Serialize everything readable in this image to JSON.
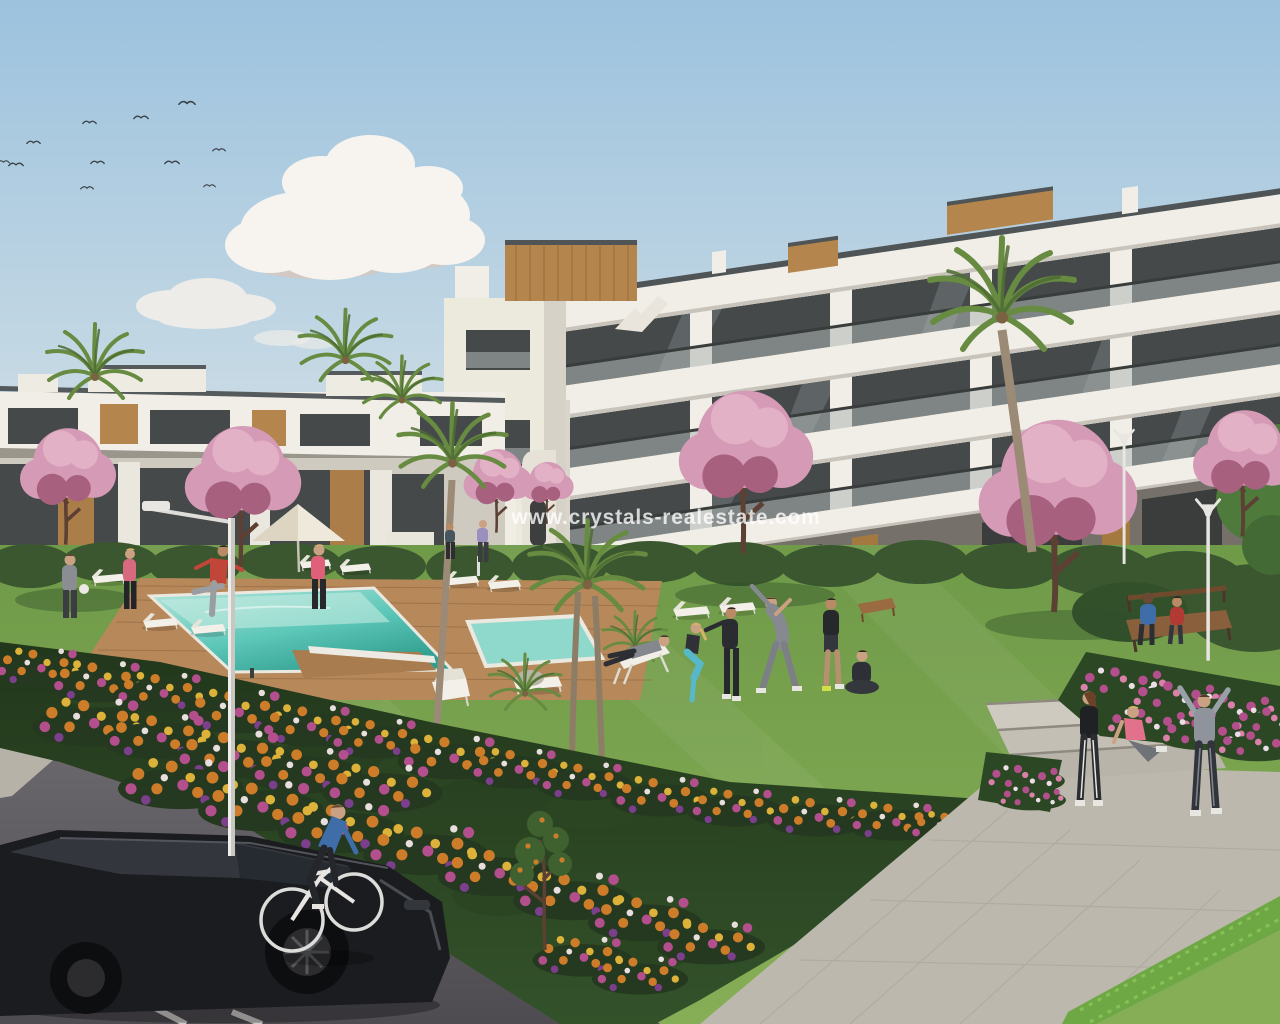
{
  "watermark": {
    "text": "www.crystals-realestate.com"
  },
  "colors": {
    "sky_top": "#9cc2de",
    "sky_horizon": "#e9e4d8",
    "cloud_white": "#f7f4ef",
    "grass_green": "#6f9a48",
    "grass_light": "#86ae56",
    "hedge_dark": "#3a5730",
    "hedge_bright": "#6da844",
    "pool_shallow": "#b7e6dc",
    "pool_water": "#5ec8b9",
    "pool_deep": "#2f9d8f",
    "pool_coping": "#ebe8e0",
    "deck_wood": "#b6885a",
    "path_light": "#bdb8ad",
    "sidewalk": "#b7b2a8",
    "road_dark": "#4e4c51",
    "building_white": "#f1eee7",
    "building_shade": "#d9d5cb",
    "glass_dark": "#45494a",
    "wood_accent": "#b5854e",
    "blossom_pink": "#d49ab6",
    "palm_green": "#678b41",
    "flower_orange": "#cd7d2a",
    "flower_magenta": "#b44f8e",
    "car_black": "#1b1c1f",
    "lamp_white": "#e8e6e2",
    "watermark_white": "#ffffff"
  }
}
